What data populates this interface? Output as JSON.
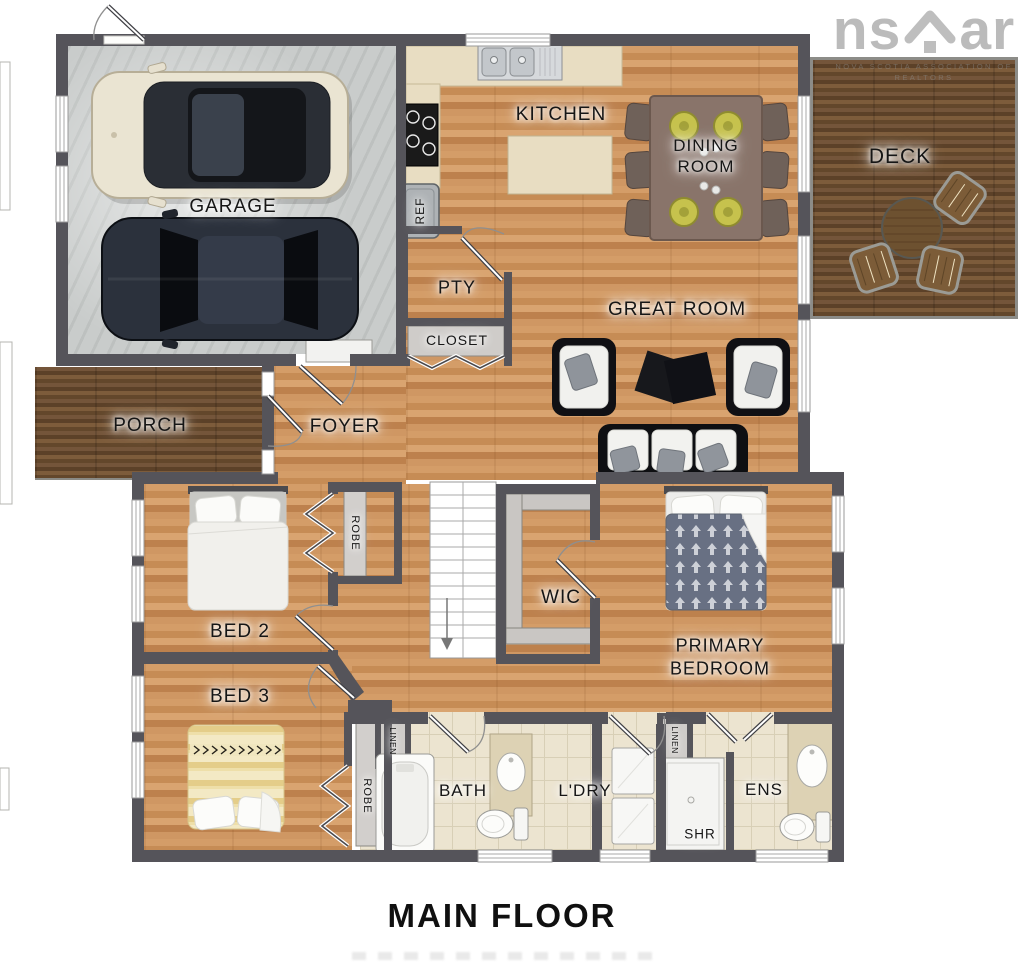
{
  "title": "MAIN FLOOR",
  "watermark": {
    "prefix": "ns",
    "suffix": "ar",
    "subtext_line1": "NOVA SCOTIA ASSOCIATION OF",
    "subtext_line2": "REALTORS"
  },
  "rooms": {
    "garage": "GARAGE",
    "kitchen": "KITCHEN",
    "dining_line1": "DINING",
    "dining_line2": "ROOM",
    "deck": "DECK",
    "great_room": "GREAT ROOM",
    "porch": "PORCH",
    "foyer": "FOYER",
    "pantry": "PTY",
    "fridge": "REF",
    "closet": "CLOSET",
    "robe_bed2": "ROBE",
    "bed2": "BED 2",
    "bed3": "BED 3",
    "robe_bed3": "ROBE",
    "wic": "WIC",
    "primary_line1": "PRIMARY",
    "primary_line2": "BEDROOM",
    "linen_bath": "LINEN",
    "bath": "BATH",
    "laundry": "L'DRY",
    "linen_ens": "LINEN",
    "shower": "SHR",
    "ensuite": "ENS"
  },
  "colors": {
    "wall": "#55545a",
    "wood_floor": "#cd9560",
    "dark_wood": "#6a4c2e",
    "tile_floor": "#ece4d0",
    "garage_floor": "#c9cccb",
    "counter_marble": "#e8ddc2",
    "plate_green": "#c6c24d",
    "watermark_gray": "#9b9b9b"
  }
}
